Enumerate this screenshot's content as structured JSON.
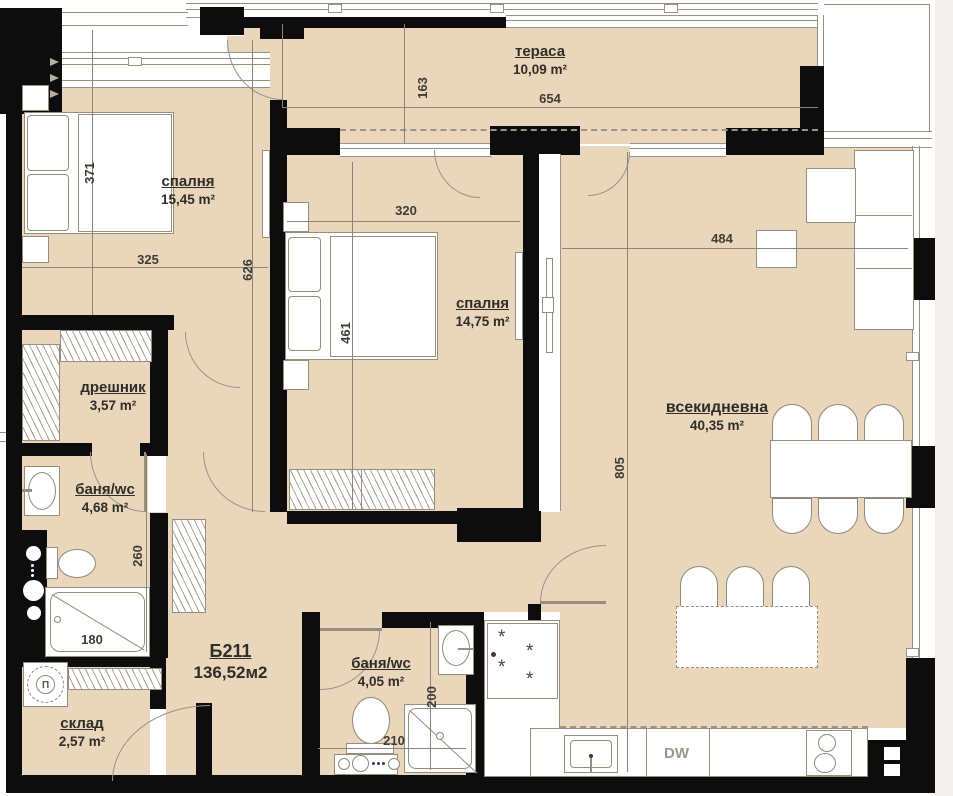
{
  "plan": {
    "unit": {
      "id": "Б211",
      "area": "136,52м2"
    },
    "rooms": [
      {
        "name": "тераса",
        "area": "10,09 m²"
      },
      {
        "name": "спалня",
        "area": "15,45 m²"
      },
      {
        "name": "спалня",
        "area": "14,75 m²"
      },
      {
        "name": "всекидневна",
        "area": "40,35 m²"
      },
      {
        "name": "дрешник",
        "area": "3,57 m²"
      },
      {
        "name": "баня/wc",
        "area": "4,68 m²"
      },
      {
        "name": "баня/wc",
        "area": "4,05 m²"
      },
      {
        "name": "склад",
        "area": "2,57 m²"
      }
    ],
    "dims": {
      "terrace_height": "163",
      "terrace_width": "654",
      "bedroom1_height": "371",
      "bedroom1_width": "325",
      "hall_height": "626",
      "bedroom2_width": "320",
      "bedroom2_height": "461",
      "living_width": "484",
      "living_height": "805",
      "bath1_height": "260",
      "bathtub_width": "180",
      "bath2_height": "200",
      "bath2_width": "210"
    },
    "appliances": {
      "dishwasher": "DW",
      "washing_machine": "П"
    },
    "colors": {
      "floor": "#e9d6bb",
      "wall": "#0d0d0d",
      "line": "#948d80"
    }
  }
}
